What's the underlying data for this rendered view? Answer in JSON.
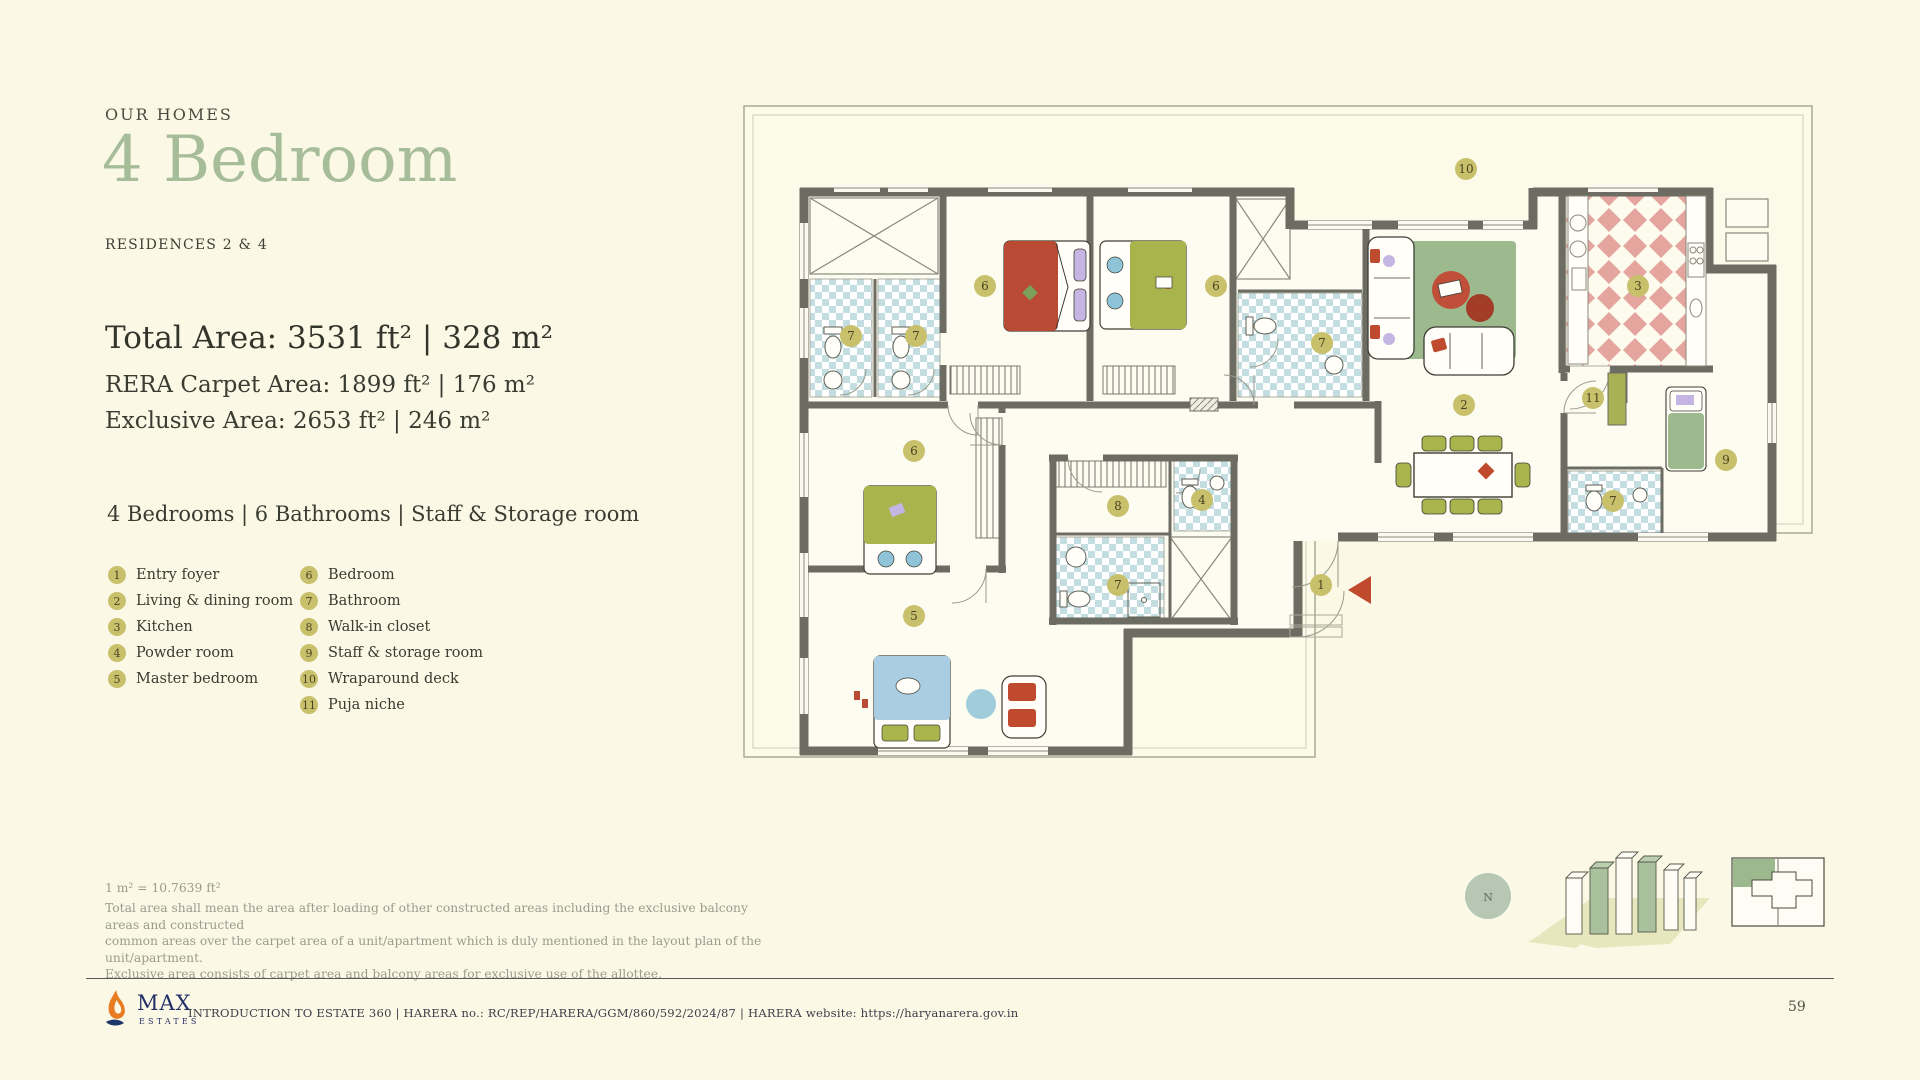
{
  "header": {
    "eyebrow": "OUR HOMES",
    "title": "4 Bedroom",
    "subtitle": "RESIDENCES 2 & 4"
  },
  "areas": {
    "total": "Total Area: 3531 ft² | 328 m²",
    "rera": "RERA Carpet Area: 1899 ft²  |  176 m²",
    "exclusive": "Exclusive Area: 2653 ft²  |  246 m²"
  },
  "amenities": "4 Bedrooms  |  6 Bathrooms  |  Staff & Storage room",
  "legend": {
    "badge_color": "#c9c06c",
    "columns": [
      [
        {
          "num": "1",
          "label": "Entry foyer"
        },
        {
          "num": "2",
          "label": "Living & dining room"
        },
        {
          "num": "3",
          "label": "Kitchen"
        },
        {
          "num": "4",
          "label": "Powder room"
        },
        {
          "num": "5",
          "label": "Master bedroom"
        }
      ],
      [
        {
          "num": "6",
          "label": "Bedroom"
        },
        {
          "num": "7",
          "label": "Bathroom"
        },
        {
          "num": "8",
          "label": "Walk-in closet"
        },
        {
          "num": "9",
          "label": "Staff & storage room"
        },
        {
          "num": "10",
          "label": "Wraparound deck"
        },
        {
          "num": "11",
          "label": "Puja niche"
        }
      ]
    ]
  },
  "plan": {
    "compass_label": "N",
    "badges": [
      {
        "num": "1",
        "x": 583,
        "y": 482
      },
      {
        "num": "2",
        "x": 726,
        "y": 302
      },
      {
        "num": "3",
        "x": 900,
        "y": 183
      },
      {
        "num": "4",
        "x": 464,
        "y": 397
      },
      {
        "num": "5",
        "x": 176,
        "y": 513
      },
      {
        "num": "6",
        "x": 247,
        "y": 183
      },
      {
        "num": "6",
        "x": 478,
        "y": 183
      },
      {
        "num": "6",
        "x": 176,
        "y": 348
      },
      {
        "num": "7",
        "x": 113,
        "y": 233
      },
      {
        "num": "7",
        "x": 178,
        "y": 233
      },
      {
        "num": "7",
        "x": 584,
        "y": 240
      },
      {
        "num": "7",
        "x": 875,
        "y": 398
      },
      {
        "num": "7",
        "x": 380,
        "y": 482
      },
      {
        "num": "8",
        "x": 380,
        "y": 403
      },
      {
        "num": "9",
        "x": 988,
        "y": 357
      },
      {
        "num": "10",
        "x": 728,
        "y": 66
      },
      {
        "num": "11",
        "x": 855,
        "y": 295
      }
    ]
  },
  "disclaimer": {
    "conversion": "1 m² = 10.7639 ft²",
    "lines": [
      "Total area shall mean the area after loading of other constructed areas including the exclusive balcony areas and constructed",
      "common areas over the carpet area of a unit/apartment which is duly mentioned in the layout plan of the unit/apartment.",
      "Exclusive area consists of carpet area and balcony areas for exclusive use of the allottee."
    ]
  },
  "footer": {
    "logo": {
      "name": "MAX",
      "sub": "ESTATES"
    },
    "text": "INTRODUCTION TO ESTATE 360 | HARERA no.: RC/REP/HARERA/GGM/860/592/2024/87 | HARERA website: https://haryanarera.gov.in",
    "page_number": "59"
  },
  "colors": {
    "page_bg": "#fbf9e6",
    "accent_green": "#a7bd9a",
    "badge_olive": "#c9c06c",
    "wall_gray": "#6c6c62",
    "bath_checker": "#c3dde1",
    "kitchen_tile": "#e3a59e",
    "rug_green": "#9cba8e",
    "furniture_olive": "#a9b44c",
    "bed_red": "#b94a33",
    "bed_blue": "#a9cde2",
    "pillow_purple": "#c4b5e3",
    "entry_arrow_red": "#bf4a2d",
    "logo_navy": "#232e66",
    "logo_orange": "#e87c22"
  }
}
